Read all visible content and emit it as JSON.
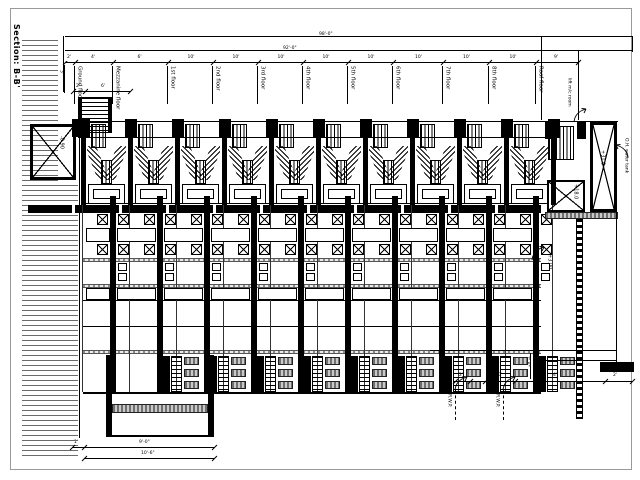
{
  "sheet": {
    "title": "Section: B-B'"
  },
  "top_dimensions": {
    "overall": "98'-0\"",
    "inner": "92'-0\"",
    "segments": [
      "2'",
      "4'",
      "6'",
      "10'",
      "10'",
      "10'",
      "10'",
      "10'",
      "10'",
      "10'",
      "10'",
      "9'"
    ]
  },
  "floors": [
    "Ground floor",
    "Mezzanine floor",
    "1st floor",
    "2nd floor",
    "3rd floor",
    "4th floor",
    "5th floor",
    "6th floor",
    "7th floor",
    "8th floor",
    "Roof floor"
  ],
  "levels": {
    "left_shaft": "-0.90",
    "lift_top": "+31.0",
    "lift_mid": "+18.0",
    "plinth": "+3.00"
  },
  "annotations": {
    "lift_room": "lift m/c room",
    "water_tank": "O.H. water tank",
    "pipe_1": "R.W.P.",
    "pipe_2": "R.W.P."
  },
  "entry_dims": {
    "segments": [
      "2'",
      "6'"
    ],
    "side": "3'"
  },
  "bottom_left_dims": {
    "segments": [
      "1'",
      "9'-0\""
    ],
    "total": "10'-6\""
  },
  "bottom_right_dims": {
    "segments": [
      "2'",
      "4'",
      "10'",
      "4'",
      "2'"
    ],
    "vertical": "7'-6\""
  }
}
